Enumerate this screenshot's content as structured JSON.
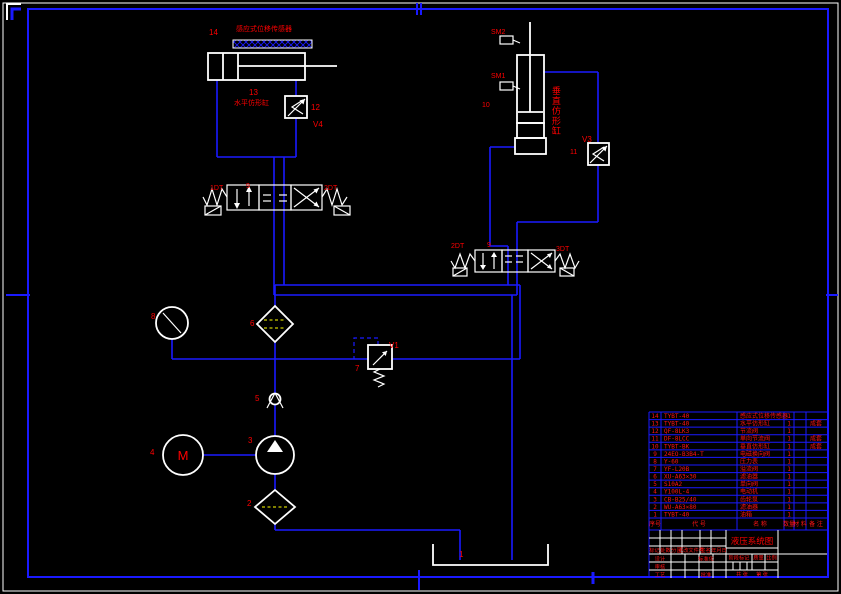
{
  "drawing": {
    "colors": {
      "background": "#000000",
      "wire": "#1a1aff",
      "symbol": "#ffffff",
      "label": "#ff0000",
      "filter_dash": "#ffff00"
    },
    "labels": {
      "n14": "14",
      "sensor_title": "感应式位移传感器",
      "n13": "13",
      "cyl13_name": "水平仿形缸",
      "n12": "12",
      "v4": "V4",
      "dt1": "1DT",
      "n9_left": "9",
      "dt2_left": "2DT",
      "sm2": "SM2",
      "sm1": "SM1",
      "n10": "10",
      "cyl10_name": "垂直仿形缸",
      "v3": "V3",
      "n11": "11",
      "dt2_right": "2DT",
      "n9_right": "9",
      "dt3": "3DT",
      "n8": "8",
      "n6": "6",
      "n5": "5",
      "n7": "7",
      "v1": "V1",
      "n4": "4",
      "motor": "M",
      "n3": "3",
      "n2": "2",
      "n1": "1"
    }
  },
  "bom": {
    "headers": [
      "序号",
      "代 号",
      "名 称",
      "数量",
      "材 料",
      "备 注"
    ],
    "rows": [
      {
        "seq": "14",
        "code": "TYBT-40",
        "name": "感应式位移传感器",
        "qty": "1",
        "material": "",
        "note": ""
      },
      {
        "seq": "13",
        "code": "TYBT-40",
        "name": "水平仿形缸",
        "qty": "1",
        "material": "",
        "note": "成套"
      },
      {
        "seq": "12",
        "code": "QF-8LK3",
        "name": "节流阀",
        "qty": "1",
        "material": "",
        "note": ""
      },
      {
        "seq": "11",
        "code": "DF-8LCC",
        "name": "单向节流阀",
        "qty": "1",
        "material": "",
        "note": "成套"
      },
      {
        "seq": "10",
        "code": "TYBT-BK",
        "name": "垂直仿形缸",
        "qty": "1",
        "material": "",
        "note": "成套"
      },
      {
        "seq": "9",
        "code": "24EO-B3B4-T",
        "name": "电磁换向阀",
        "qty": "1",
        "material": "",
        "note": ""
      },
      {
        "seq": "8",
        "code": "Y-60",
        "name": "压力表",
        "qty": "1",
        "material": "",
        "note": ""
      },
      {
        "seq": "7",
        "code": "YF-L20B",
        "name": "溢流阀",
        "qty": "1",
        "material": "",
        "note": ""
      },
      {
        "seq": "6",
        "code": "XU-A63×30",
        "name": "滤油器",
        "qty": "1",
        "material": "",
        "note": ""
      },
      {
        "seq": "5",
        "code": "S10A2",
        "name": "单向阀",
        "qty": "1",
        "material": "",
        "note": ""
      },
      {
        "seq": "4",
        "code": "Y100L-4",
        "name": "电动机",
        "qty": "1",
        "material": "",
        "note": ""
      },
      {
        "seq": "3",
        "code": "CB-B25/40",
        "name": "齿轮泵",
        "qty": "1",
        "material": "",
        "note": ""
      },
      {
        "seq": "2",
        "code": "WU-A63×80",
        "name": "滤油器",
        "qty": "1",
        "material": "",
        "note": ""
      },
      {
        "seq": "1",
        "code": "TYBT-40",
        "name": "油箱",
        "qty": "1",
        "material": "",
        "note": ""
      }
    ]
  },
  "title_block": {
    "title": "液压系统图",
    "marks": [
      "标记",
      "处数",
      "分区",
      "更改文件号",
      "签名",
      "年月日"
    ],
    "design": "设计",
    "standardization": "标准化",
    "audit": "审核",
    "process": "工艺",
    "approve": "批准",
    "stage_mark": "阶段标记",
    "weight": "质量",
    "scale": "比例",
    "sheets_total": "共 张",
    "sheet_no": "第 张"
  }
}
